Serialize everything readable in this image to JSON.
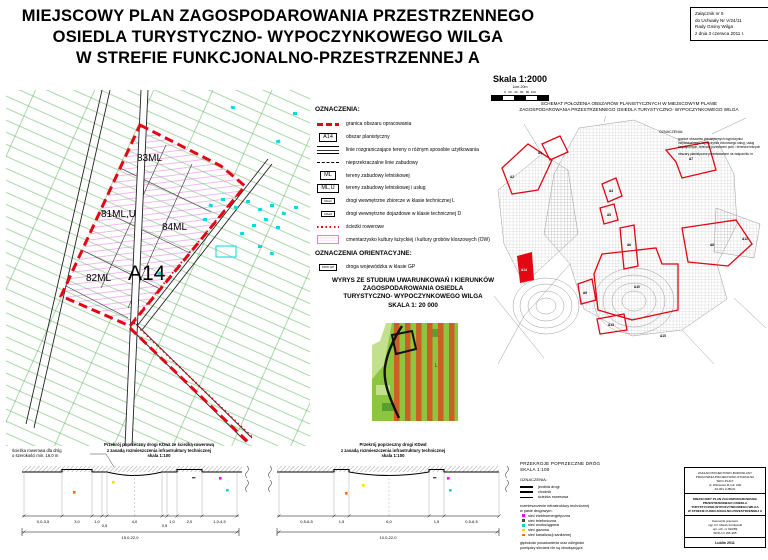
{
  "colors": {
    "boundary_red": "#e30613",
    "parcel_green": "#55b154",
    "building_cyan": "#00dbdb",
    "hatch_pink": "#f2a6f0",
    "infra_elektro": "#ff00ff",
    "infra_telefon": "#4d4d4d",
    "infra_woda": "#00d5d5",
    "infra_gaz": "#ffd900",
    "infra_kanalizacja": "#ff6a00"
  },
  "header": {
    "title_lines": [
      "MIEJSCOWY PLAN ZAGOSPODAROWANIA  PRZESTRZENNEGO",
      "OSIEDLA  TURYSTYCZNO- WYPOCZYNKOWEGO WILGA",
      "W STREFIE FUNKCJONALNO-PRZESTRZENNEJ  A"
    ],
    "attachment_lines": [
      "Załącznik nr 5",
      "do Uchwały Nr V/24/11",
      "Rady Gminy Wilga",
      "z dnia 3 czerwca 2011 r."
    ],
    "scale": {
      "label": "Skala  1:2000",
      "sub": "1cm-20m",
      "ticks": "0   20   40   60   80  100"
    }
  },
  "main_map": {
    "labels": {
      "l83": "83ML",
      "l81": "81ML,U",
      "l84": "84ML",
      "l82": "82ML",
      "area": "A14"
    }
  },
  "legend": {
    "title": "OZNACZENIA:",
    "items": [
      {
        "label": "granica obszaru opracowania"
      },
      {
        "symbol": "A14",
        "label": "obszar planistyczny"
      },
      {
        "label": "linie rozgraniczające tereny o różnym sposobie użytkowania"
      },
      {
        "label": "nieprzekraczalne linie zabudowy"
      },
      {
        "symbol": "ML",
        "label": "tereny zabudowy letniskowej"
      },
      {
        "symbol": "ML,U",
        "label": "tereny zabudowy letniskowej i usług"
      },
      {
        "symbol": "KDwz",
        "label": "drogi wewnętrzne zbiorcze w klasie technicznej L"
      },
      {
        "symbol": "KDwd",
        "label": "drogi wewnętrzne dojazdowe w klasie technicznej D"
      },
      {
        "label": "ścieżki rowerowe"
      },
      {
        "label": "cmentarzysko kultury łużyckiej i kultury grobów kloszowych (OW)"
      }
    ]
  },
  "orient_legend": {
    "title": "OZNACZENIA ORIENTACYJNE:",
    "symbol": "KDW GP",
    "label": "droga wojewódzka w klasie GP"
  },
  "study": {
    "title_lines": [
      "WYRYS ZE STUDIUM UWARUNKOWAŃ I KIERUNKÓW",
      "ZAGOSPODAROWANIA OSIEDLA",
      "TURYSTYCZNO- WYPOCZYNKOWEGO WILGA",
      "SKALA 1: 20 000"
    ],
    "map_label": "L"
  },
  "schematic": {
    "title_lines": [
      "SCHEMAT POŁOŻENIA OBSZARÓW PLANISTYCZNYCH  W  MIEJSCOWYM  PLANIE",
      "ZAGOSPODAROWANIA PRZESTRZENNEGO OSIEDLA TURYSTYCZNO- WYPOCZYNKOWEGO WILGA"
    ],
    "legend_title": "OZNACZENIA:",
    "legend_items": [
      "granice obszarów planistycznych wypoczynku indywidualnego, wypoczynku zbiorowego usług, usług turystycznych, terenów przestrzeni publ. i terenów leśnych",
      "obszary planistyczne przedstawione na załączniku nr"
    ],
    "area_labels": [
      "A1",
      "A2",
      "A4",
      "A5",
      "A6",
      "A7",
      "A8",
      "A9",
      "A10",
      "A12",
      "A13",
      "A14",
      "A15"
    ]
  },
  "sections": [
    {
      "note_lines": [
        "ścieżka rowerowa dla dróg",
        "o szerokości min. 16,0 m"
      ],
      "title_lines": [
        "Przekrój poprzeczny  drogi KDwz ze ścieżką rowerową",
        "z zasadą rozmieszczenia infrastruktury technicznej",
        "skala 1:100"
      ],
      "dims": [
        "0,0-3,5",
        "3,0",
        "1,0",
        "0,5",
        "4,0",
        "0,5",
        "1,0",
        "2,0",
        "1,0-4,5"
      ],
      "total": "15,0-22,0"
    },
    {
      "title_lines": [
        "Przekrój poprzeczny drogi KDwd",
        "z zasadą rozmieszczenia infrastruktury technicznej",
        "skala 1:100"
      ],
      "dims": [
        "0,5-6,5",
        "1,5",
        "6,0",
        "1,5",
        "0,5-6,5"
      ],
      "total": "10,0-22,0"
    }
  ],
  "sections_legend": {
    "title_lines": [
      "PRZEKROJE POPRZECZNE DRÓG",
      "SKALA 1:100"
    ],
    "oznaczenia_title": "OZNACZENIA:",
    "line_items": [
      "jezdnia drogi",
      "chodnik",
      "ścieżka rowerowa"
    ],
    "infra_intro_lines": [
      "rozmieszczenie infrastruktury technicznej",
      "w pasie drogowym:"
    ],
    "infra_items": [
      "sieć elektroenergetyczna",
      "sieć telefoniczna",
      "sieć wodociągowa",
      "sieć gazowa",
      "sieć kanalizacji sanitarnej"
    ],
    "note_lines": [
      "głębokość posadowienia oraz odległości",
      "pomiędzy sieciami nie są obowiązujące"
    ]
  },
  "title_block": {
    "company_lines": [
      "ZAKŁAD PROJEKTOWO-BUDOWLANY",
      "PRACOWNIA PROJEKTOWO-STUDIALNA",
      "\"EKO-PLAN\"",
      "ul. Wiśniowa 11 lok. 206",
      "20-001 LUBLIN"
    ],
    "plan_lines": [
      "MIEJSCOWY PLAN ZAGOSPODAROWANIA",
      "PRZESTRZENNEGO OSIEDLA",
      "TURYSTYCZNO-WYPOCZYNKOWEGO WILGA",
      "W STREFIE FUNKCJONALNO-PRZESTRZENNEJ A"
    ],
    "author_lines": [
      "Kierownik pracowni",
      "mgr inż. Marek Kozłowski",
      "upr. urb. nr 922/89",
      "WOIU nr WA-395"
    ],
    "footer": "Lublin 2011"
  }
}
